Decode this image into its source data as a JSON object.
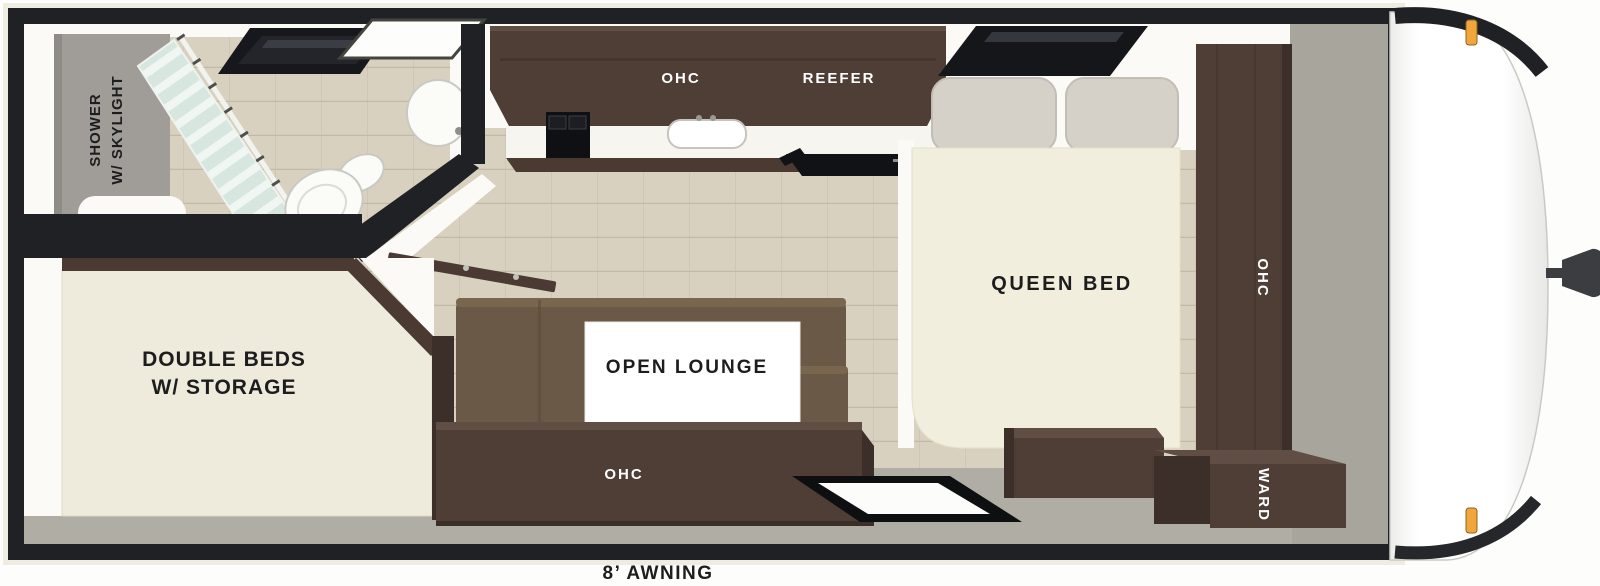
{
  "floorplan": {
    "description": "Travel trailer floor plan, top-down dollhouse view",
    "labels": {
      "shower_line1": "SHOWER",
      "shower_line2": "W/ SKYLIGHT",
      "kitchen_ohc": "OHC",
      "reefer": "REEFER",
      "queen_bed": "QUEEN BED",
      "bedside_ohc": "OHC",
      "ward": "WARD",
      "double_beds_line1": "DOUBLE BEDS",
      "double_beds_line2": "W/ STORAGE",
      "open_lounge": "OPEN LOUNGE",
      "lounge_ohc": "OHC",
      "awning": "8’ AWNING"
    },
    "colors": {
      "wall": "#202124",
      "wood": "#d8d1bf",
      "plank": "#c2ba a5",
      "cabinet": "#4e3e36",
      "cabinet_top": "#604e44",
      "cabinet_dark": "#3c2f29",
      "sofa": "#6b5948",
      "sofa_hi": "#79664f",
      "mattress": "#f1eedd",
      "bed": "#eeeadc",
      "pillow": "#d5d1c9",
      "floor_gray": "#b0ada5",
      "zone_gray": "#a8a59d",
      "white_wall": "#fbfaf6",
      "amber": "#f0a63c",
      "shower_wall": "#a09d98"
    }
  }
}
